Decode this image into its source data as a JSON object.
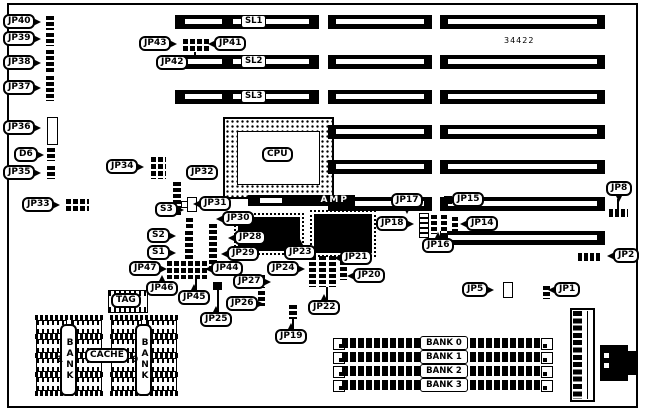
{
  "board_number": "34422",
  "labels": {
    "jp1": "JP1",
    "jp2": "JP2",
    "jp5": "JP5",
    "jp8": "JP8",
    "jp14": "JP14",
    "jp15": "JP15",
    "jp16": "JP16",
    "jp17": "JP17",
    "jp18": "JP18",
    "jp19": "JP19",
    "jp20": "JP20",
    "jp21": "JP21",
    "jp22": "JP22",
    "jp23": "JP23",
    "jp24": "JP24",
    "jp25": "JP25",
    "jp26": "JP26",
    "jp27": "JP27",
    "jp28": "JP28",
    "jp29": "JP29",
    "jp30": "JP30",
    "jp31": "JP31",
    "jp32": "JP32",
    "jp33": "JP33",
    "jp34": "JP34",
    "jp35": "JP35",
    "jp36": "JP36",
    "jp37": "JP37",
    "jp38": "JP38",
    "jp39": "JP39",
    "jp40": "JP40",
    "jp41": "JP41",
    "jp42": "JP42",
    "jp43": "JP43",
    "jp44": "JP44",
    "jp45": "JP45",
    "jp46": "JP46",
    "jp47": "JP47",
    "d6": "D6",
    "s1": "S1",
    "s2": "S2",
    "s3": "S3"
  },
  "slots": {
    "sl1": "SL1",
    "sl2": "SL2",
    "sl3": "SL3"
  },
  "cpu_label": "CPU",
  "cpu_socket_brand": "AMP",
  "cache_label": "CACHE",
  "tag_label": "TAG",
  "cache_banks": {
    "bank1": "BANK 1",
    "bank0": "BANK 0"
  },
  "simm_banks": [
    "BANK 0",
    "BANK 1",
    "BANK 2",
    "BANK 3"
  ]
}
